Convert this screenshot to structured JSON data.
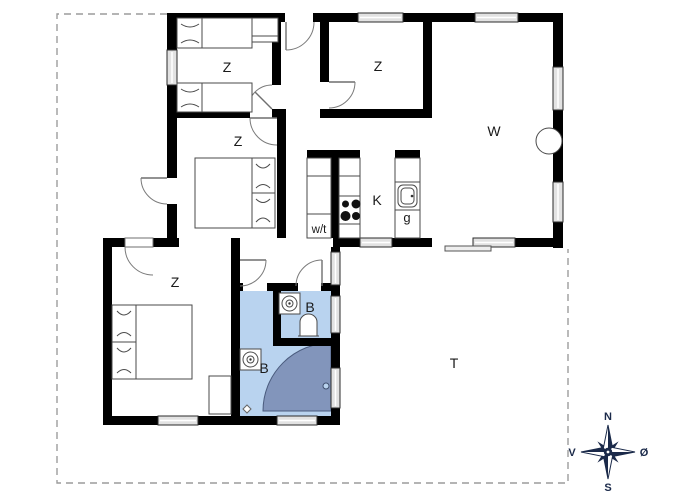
{
  "floorplan": {
    "rooms": {
      "bedroom_nw": "Z",
      "bedroom_n": "Z",
      "bedroom_mid": "Z",
      "bedroom_sw": "Z",
      "living": "W",
      "kitchen": "K",
      "sink_unit": "g",
      "utility": "w/t",
      "bath_small": "B",
      "bath_large": "B",
      "terrace": "T"
    },
    "compass": {
      "north": "N",
      "south": "S",
      "west": "V",
      "east": "Ø"
    },
    "colors": {
      "wall": "#000000",
      "bath_floor": "#b9d3ef",
      "shower": "#8295bb",
      "window_fill": "#e2e2e2",
      "dash": "#9c9c9c",
      "label": "#1a1a1a",
      "compass": "#1b2a4a"
    }
  }
}
